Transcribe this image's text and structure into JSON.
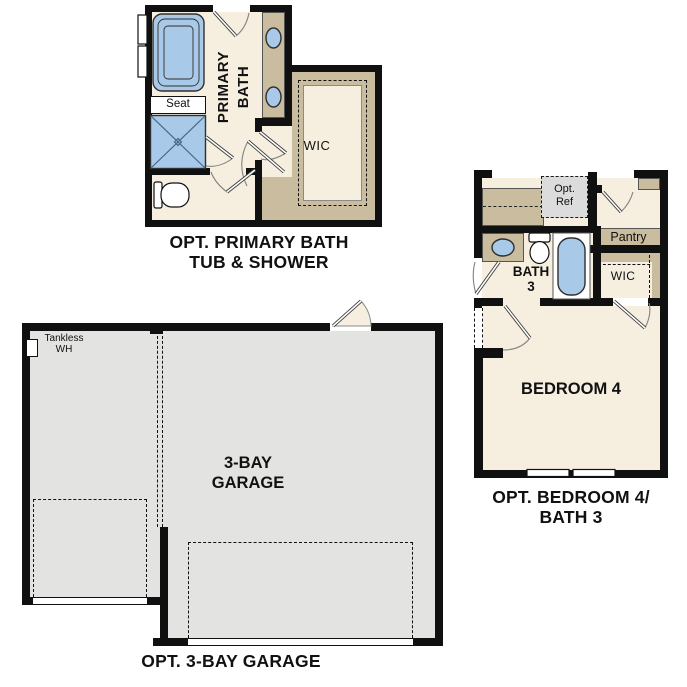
{
  "colors": {
    "wall": "#101010",
    "room_cream": "#f6efe0",
    "tan": "#c9bc9f",
    "fixture_blue": "#a9c9e8",
    "fixture_outline": "#2f2f2f",
    "garage_gray": "#e3e3e1",
    "optref_gray": "#dcdcdc",
    "door_dark": "#3d3d3d",
    "arc": "#828282",
    "text": "#111111"
  },
  "primary_bath": {
    "caption": [
      "OPT. PRIMARY BATH",
      "TUB & SHOWER"
    ],
    "room_label": [
      "PRIMARY",
      "BATH"
    ],
    "seat_label": "Seat",
    "wic_label": "WIC"
  },
  "bedroom4": {
    "caption": [
      "OPT. BEDROOM 4/",
      "BATH 3"
    ],
    "room_label": "BEDROOM 4",
    "opt_ref_label": [
      "Opt.",
      "Ref"
    ],
    "pantry_label": "Pantry",
    "bath_label": [
      "BATH",
      "3"
    ],
    "wic_label": "WIC"
  },
  "garage": {
    "caption": "OPT. 3-BAY GARAGE",
    "room_label": [
      "3-BAY",
      "GARAGE"
    ],
    "tankless_label": [
      "Tankless",
      "WH"
    ]
  }
}
